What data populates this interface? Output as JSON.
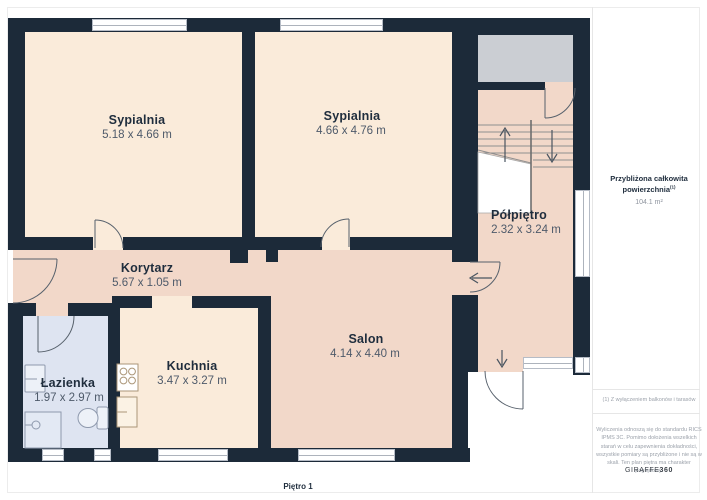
{
  "rooms": {
    "bedroom1": {
      "name": "Sypialnia",
      "dims": "5.18 x 4.66 m"
    },
    "bedroom2": {
      "name": "Sypialnia",
      "dims": "4.66 x 4.76 m"
    },
    "halflanding": {
      "name": "Półpiętro",
      "dims": "2.32 x 3.24 m"
    },
    "corridor": {
      "name": "Korytarz",
      "dims": "5.67 x 1.05 m"
    },
    "bathroom": {
      "name": "Łazienka",
      "dims": "1.97 x 2.97 m"
    },
    "kitchen": {
      "name": "Kuchnia",
      "dims": "3.47 x 3.27 m"
    },
    "salon": {
      "name": "Salon",
      "dims": "4.14 x 4.40 m"
    }
  },
  "sidebar": {
    "area_label_line1": "Przybliżona całkowita",
    "area_label_line2": "powierzchnia",
    "area_label_sup": "(1)",
    "area_value": "104.1 m²",
    "footnote": "(1) Z wyłączeniem balkonów i tarasów",
    "disclaimer": "Wyliczenia odnoszą się do standardu RICS IPMS 3C. Pomimo dołożenia wszelkich starań w celu zapewnienia dokładności, wszystkie pomiary są przybliżone i nie są w skali. Ten plan piętra ma charakter poglądowy.",
    "brand_normal": "GIRAFFE",
    "brand_bold": "360"
  },
  "footer": {
    "floor_label": "Piętro 1"
  },
  "colors": {
    "wall": "#1C2A39",
    "bedroom_fill": "#FAEBDA",
    "living_fill": "#F2D8C9",
    "bathroom_fill": "#DEE4F1",
    "balcony_fill": "#CBCED3",
    "window_frame": "#B6BCC6"
  }
}
